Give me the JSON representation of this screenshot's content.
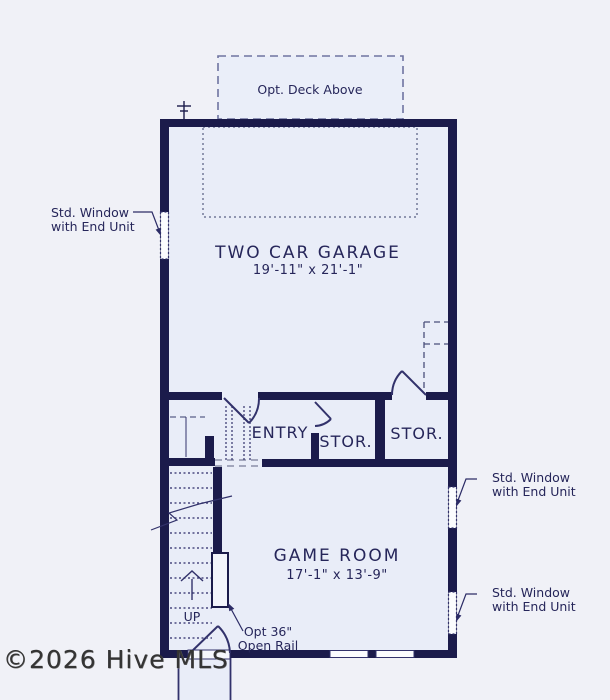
{
  "colors": {
    "wall": "#1b1b4b",
    "linework": "#32326b",
    "room_fill": "#e9edf8",
    "background": "#f0f1f7",
    "dotted_outline": "#9096b0",
    "label_text": "#26265a",
    "watermark_text": "#343434"
  },
  "deck": {
    "label": "Opt. Deck Above"
  },
  "rooms": {
    "garage": {
      "name": "TWO CAR GARAGE",
      "dims": "19'-11\" x 21'-1\""
    },
    "entry": {
      "name": "ENTRY"
    },
    "storage1": {
      "name": "STOR."
    },
    "storage2": {
      "name": "STOR."
    },
    "game_room": {
      "name": "GAME ROOM",
      "dims": "17'-1\" x 13'-9\""
    }
  },
  "annotations": {
    "window_left": {
      "line1": "Std. Window",
      "line2": "with End Unit"
    },
    "window_right_upper": {
      "line1": "Std. Window",
      "line2": "with End Unit"
    },
    "window_right_lower": {
      "line1": "Std. Window",
      "line2": "with End Unit"
    },
    "open_rail": {
      "line1": "Opt 36\"",
      "line2": "Open Rail"
    },
    "stair_direction": "UP"
  },
  "watermark": "©2026 Hive MLS"
}
